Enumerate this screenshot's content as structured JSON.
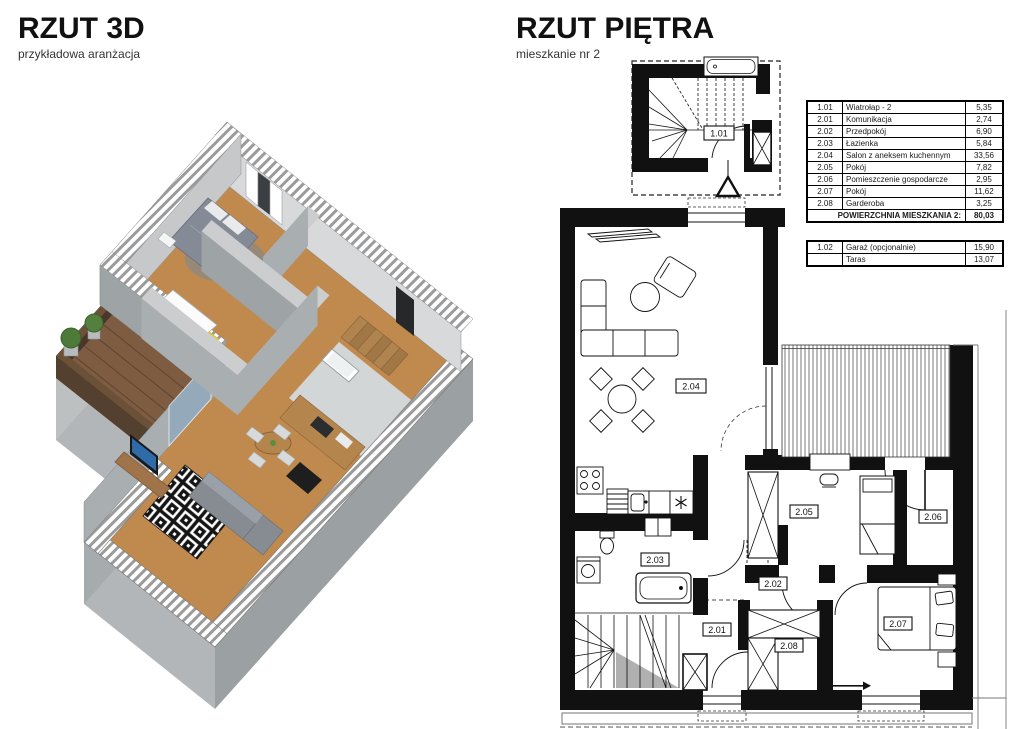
{
  "left_panel": {
    "title": "RZUT 3D",
    "subtitle": "przykładowa aranżacja"
  },
  "right_panel": {
    "title": "RZUT PIĘTRA",
    "subtitle": "mieszkanie nr 2"
  },
  "area_table": {
    "rows": [
      {
        "no": "1.01",
        "name": "Wiatrołap - 2",
        "area": "5,35"
      },
      {
        "no": "2.01",
        "name": "Komunikacja",
        "area": "2,74"
      },
      {
        "no": "2.02",
        "name": "Przedpokój",
        "area": "6,90"
      },
      {
        "no": "2.03",
        "name": "Łazienka",
        "area": "5,84"
      },
      {
        "no": "2.04",
        "name": "Salon z aneksem kuchennym",
        "area": "33,56"
      },
      {
        "no": "2.05",
        "name": "Pokój",
        "area": "7,82"
      },
      {
        "no": "2.06",
        "name": "Pomieszczenie gospodarcze",
        "area": "2,95"
      },
      {
        "no": "2.07",
        "name": "Pokój",
        "area": "11,62"
      },
      {
        "no": "2.08",
        "name": "Garderoba",
        "area": "3,25"
      }
    ],
    "total_label": "POWIERZCHNIA MIESZKANIA 2:",
    "total_value": "80,03",
    "extra_rows": [
      {
        "no": "1.02",
        "name": "Garaż (opcjonalnie)",
        "area": "15,90"
      },
      {
        "no": "",
        "name": "Taras",
        "area": "13,07"
      }
    ]
  },
  "plan_labels": {
    "l101": "1.01",
    "l201": "2.01",
    "l202": "2.02",
    "l203": "2.03",
    "l204": "2.04",
    "l205": "2.05",
    "l206": "2.06",
    "l207": "2.07",
    "l208": "2.08"
  },
  "colors": {
    "wall": "#111111",
    "wood_floor": "#c08a4e",
    "terrace_deck": "#7d5c41",
    "tv_screen": "#2f6ba8"
  }
}
